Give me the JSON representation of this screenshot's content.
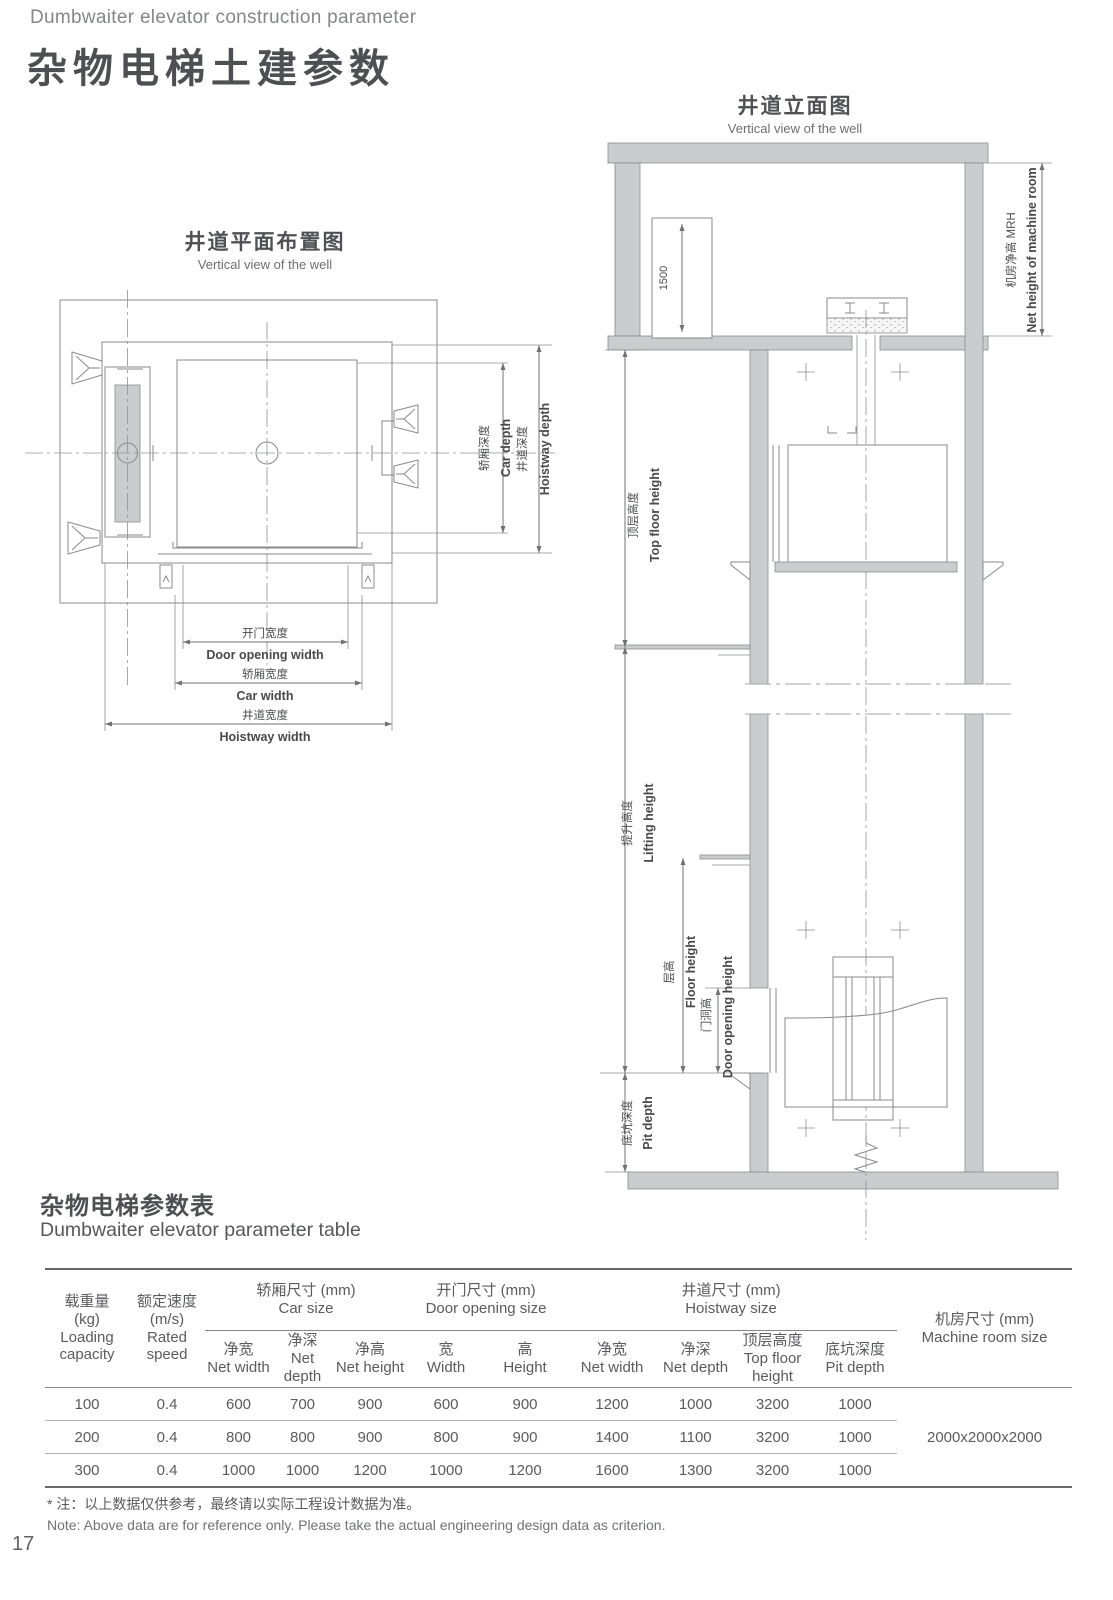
{
  "header": {
    "eyebrow": "Dumbwaiter elevator construction parameter",
    "title": "杂物电梯土建参数"
  },
  "plan": {
    "title_zh": "井道平面布置图",
    "title_en": "Vertical view of the well",
    "dims": {
      "door_opening_width_zh": "开门宽度",
      "door_opening_width_en": "Door opening width",
      "car_width_zh": "轿厢宽度",
      "car_width_en": "Car width",
      "hoistway_width_zh": "井道宽度",
      "hoistway_width_en": "Hoistway width",
      "car_depth_zh": "轿厢深度",
      "car_depth_en": "Car depth",
      "hoistway_depth_zh": "井道深度",
      "hoistway_depth_en": "Hoistway depth"
    }
  },
  "elevation": {
    "title_zh": "井道立面图",
    "title_en": "Vertical view of the well",
    "dims": {
      "machine_height": "1500",
      "mrh_zh": "机房净高 MRH",
      "mrh_en": "Net height of machine room",
      "top_floor_zh": "顶层高度",
      "top_floor_en": "Top floor height",
      "lifting_zh": "提升高度",
      "lifting_en": "Lifting height",
      "floor_zh": "层高",
      "floor_en": "Floor height",
      "door_zh": "门洞高",
      "door_en": "Door opening height",
      "pit_zh": "底坑深度",
      "pit_en": "Pit depth"
    }
  },
  "table_section": {
    "title_zh": "杂物电梯参数表",
    "title_en": "Dumbwaiter elevator parameter table"
  },
  "table": {
    "col_loading": {
      "zh": "载重量",
      "unit": "(kg)",
      "en": "Loading capacity"
    },
    "col_speed": {
      "zh": "额定速度",
      "unit": "(m/s)",
      "en": "Rated speed"
    },
    "group_car": {
      "zh": "轿厢尺寸 (mm)",
      "en": "Car size"
    },
    "group_door": {
      "zh": "开门尺寸 (mm)",
      "en": "Door opening size"
    },
    "group_hoistway": {
      "zh": "井道尺寸 (mm)",
      "en": "Hoistway size"
    },
    "col_machine": {
      "zh": "机房尺寸 (mm)",
      "en": "Machine room size"
    },
    "sub": {
      "net_width": {
        "zh": "净宽",
        "en": "Net width"
      },
      "net_depth": {
        "zh": "净深",
        "en": "Net depth"
      },
      "net_height": {
        "zh": "净高",
        "en": "Net height"
      },
      "width": {
        "zh": "宽",
        "en": "Width"
      },
      "height": {
        "zh": "高",
        "en": "Height"
      },
      "hw_net_width": {
        "zh": "净宽",
        "en": "Net width"
      },
      "hw_net_depth": {
        "zh": "净深",
        "en": "Net depth"
      },
      "top_floor": {
        "zh": "顶层高度",
        "en": "Top floor height"
      },
      "pit_depth": {
        "zh": "底坑深度",
        "en": "Pit depth"
      }
    },
    "rows": [
      [
        "100",
        "0.4",
        "600",
        "700",
        "900",
        "600",
        "900",
        "1200",
        "1000",
        "3200",
        "1000"
      ],
      [
        "200",
        "0.4",
        "800",
        "800",
        "900",
        "800",
        "900",
        "1400",
        "1100",
        "3200",
        "1000"
      ],
      [
        "300",
        "0.4",
        "1000",
        "1000",
        "1200",
        "1000",
        "1200",
        "1600",
        "1300",
        "3200",
        "1000"
      ]
    ],
    "machine_room_value": "2000x2000x2000"
  },
  "notes": {
    "zh": "* 注：以上数据仅供参考，最终请以实际工程设计数据为准。",
    "en": "Note: Above data are for reference only. Please take the actual engineering design data as criterion."
  },
  "page_number": "17"
}
